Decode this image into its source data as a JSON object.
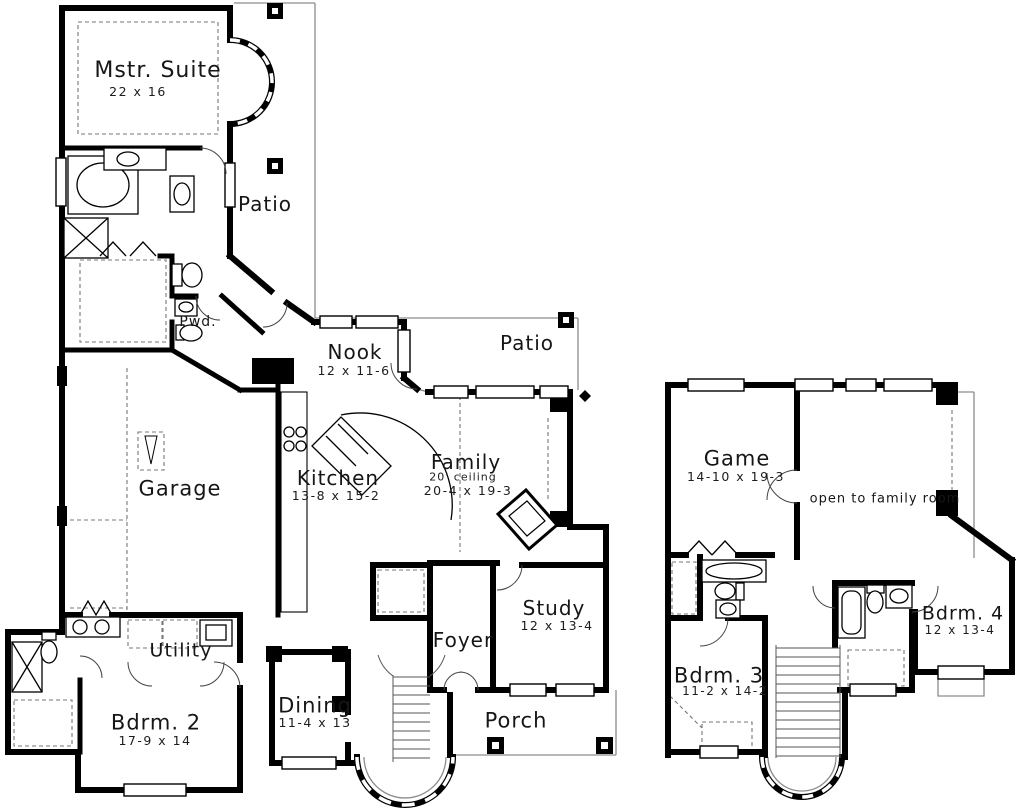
{
  "plan": {
    "background": "#ffffff",
    "wall_color": "#000000",
    "thin_line_color": "#8c8c8c",
    "dash_color": "#777777",
    "text_color": "#161616"
  },
  "first_floor": {
    "rooms": [
      {
        "id": "mstr_suite",
        "label": "Mstr. Suite",
        "dims": "22 x 16"
      },
      {
        "id": "patio_top",
        "label": "Patio",
        "dims": ""
      },
      {
        "id": "pwd",
        "label": "Pwd.",
        "dims": ""
      },
      {
        "id": "nook",
        "label": "Nook",
        "dims": "12 x 11-6"
      },
      {
        "id": "patio_right",
        "label": "Patio",
        "dims": ""
      },
      {
        "id": "garage",
        "label": "Garage",
        "dims": ""
      },
      {
        "id": "kitchen",
        "label": "Kitchen",
        "dims": "13-8 x 15-2"
      },
      {
        "id": "family",
        "label": "Family",
        "note": "20' ceiling",
        "dims": "20-4 x 19-3"
      },
      {
        "id": "study",
        "label": "Study",
        "dims": "12 x 13-4"
      },
      {
        "id": "utility",
        "label": "Utility",
        "dims": ""
      },
      {
        "id": "foyer",
        "label": "Foyer",
        "dims": ""
      },
      {
        "id": "bdrm2",
        "label": "Bdrm. 2",
        "dims": "17-9 x 14"
      },
      {
        "id": "dining",
        "label": "Dining",
        "dims": "11-4 x 13"
      },
      {
        "id": "porch",
        "label": "Porch",
        "dims": ""
      }
    ]
  },
  "second_floor": {
    "rooms": [
      {
        "id": "game",
        "label": "Game",
        "dims": "14-10 x 19-3"
      },
      {
        "id": "open_to_family",
        "label": "open to family room",
        "dims": ""
      },
      {
        "id": "bdrm4",
        "label": "Bdrm. 4",
        "dims": "12 x 13-4"
      },
      {
        "id": "bdrm3",
        "label": "Bdrm. 3",
        "dims": "11-2 x 14-2"
      }
    ]
  }
}
